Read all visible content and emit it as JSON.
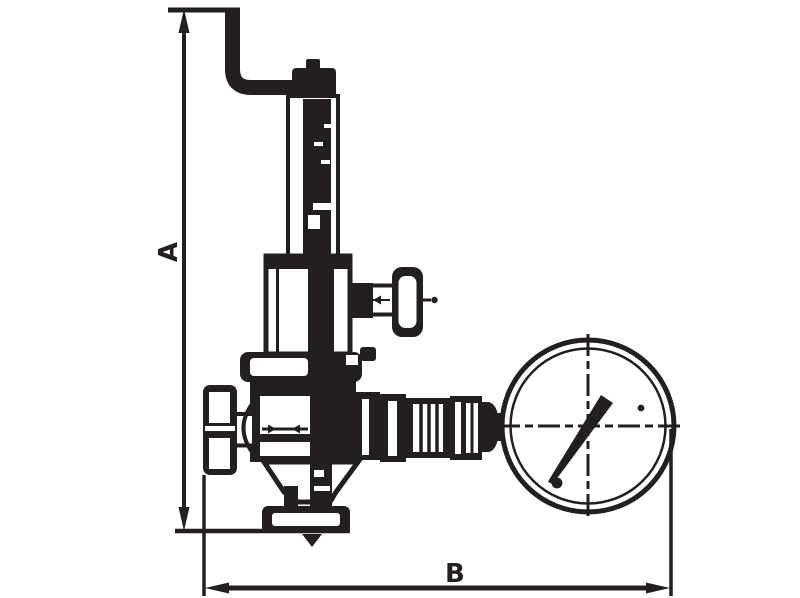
{
  "diagram": {
    "type": "technical-dimension-drawing",
    "subject": "pressure-reducing-valve-with-pressure-gauge",
    "background_color": "#ffffff",
    "line_color": "#231f20"
  },
  "labels": {
    "dim_a": "A",
    "dim_b": "B"
  },
  "dimensions": [
    {
      "label": "A",
      "orientation": "vertical"
    },
    {
      "label": "B",
      "orientation": "horizontal"
    }
  ],
  "parts": [
    "adjusting-rod",
    "spring-housing",
    "bonnet",
    "side-valve-handwheel",
    "top-flange",
    "valve-body",
    "inlet-cap",
    "outlet-fittings",
    "pressure-gauge",
    "bottom-outlet-flange"
  ]
}
